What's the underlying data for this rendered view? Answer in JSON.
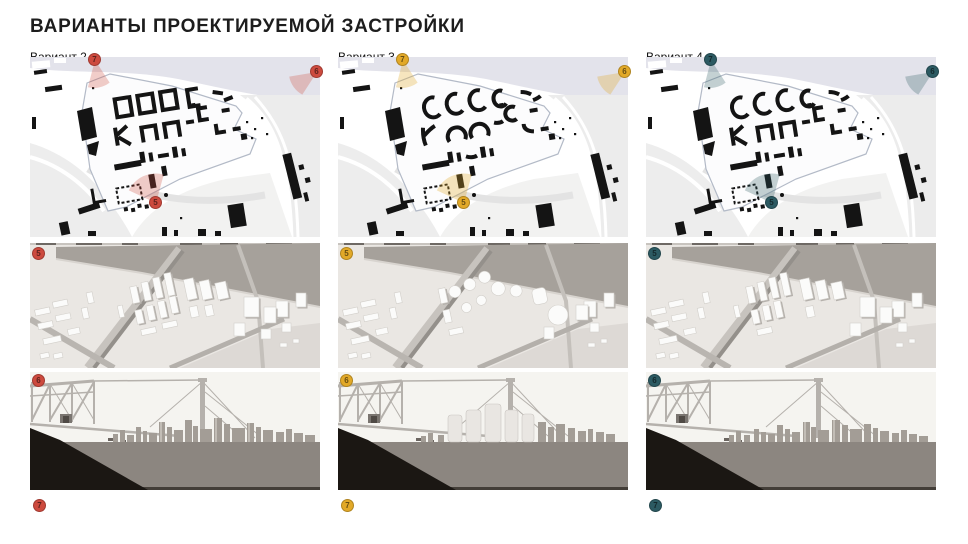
{
  "page": {
    "title": "ВАРИАНТЫ ПРОЕКТИРУЕМОЙ ЗАСТРОЙКИ",
    "background": "#ffffff"
  },
  "variants": [
    {
      "label": "Вариант 2",
      "accent": "#cd4a3e",
      "cone": "rgba(205,74,62,0.28)",
      "markers": {
        "map_topleft": "7",
        "map_topright": "6",
        "map_center": "5",
        "axon": "5",
        "skyline": "6",
        "bottom": "7"
      }
    },
    {
      "label": "Вариант 3",
      "accent": "#e2a928",
      "cone": "rgba(226,169,40,0.30)",
      "markers": {
        "map_topleft": "7",
        "map_topright": "6",
        "map_center": "5",
        "axon": "5",
        "skyline": "6",
        "bottom": "7"
      }
    },
    {
      "label": "Вариант 4",
      "accent": "#2c5a62",
      "cone": "rgba(44,90,98,0.28)",
      "markers": {
        "map_topleft": "7",
        "map_topright": "6",
        "map_center": "5",
        "axon": "5",
        "skyline": "6",
        "bottom": "7"
      }
    }
  ]
}
